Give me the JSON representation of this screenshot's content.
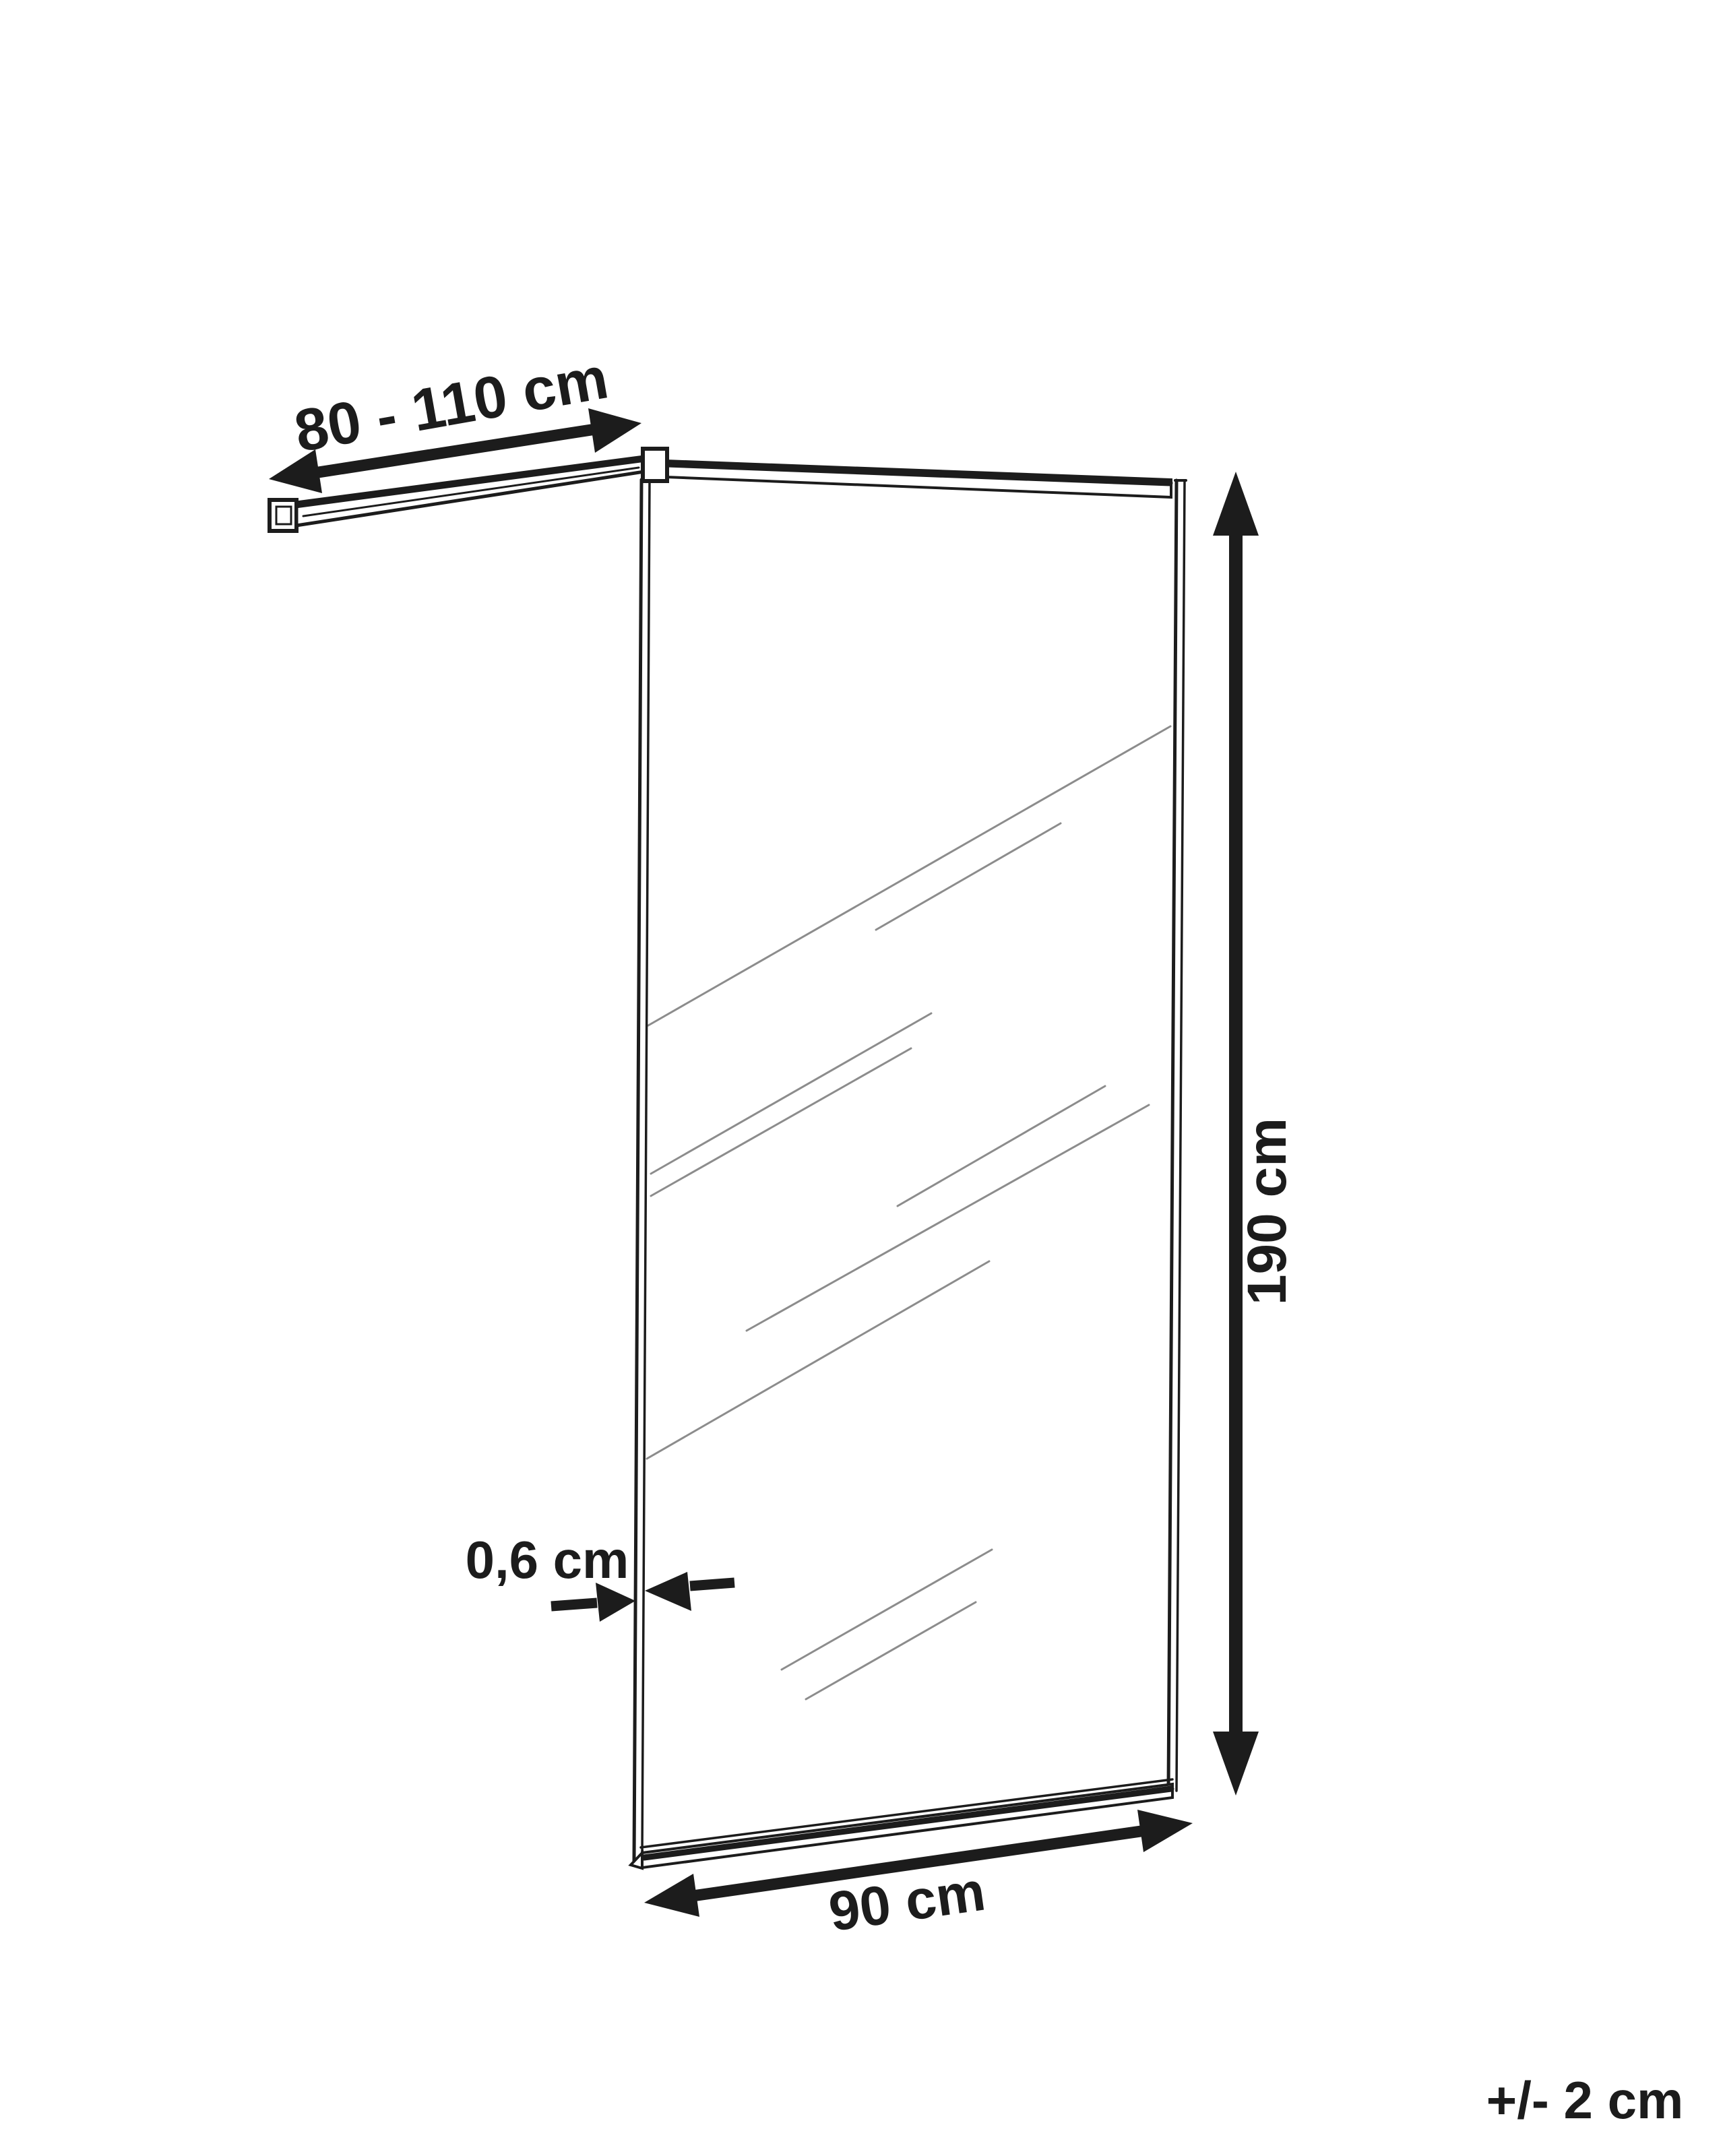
{
  "diagram": {
    "type": "product-dimension-drawing",
    "subject": "walk-in shower glass screen with ceiling support bar",
    "background_color": "#ffffff",
    "line_color": "#1c1c1c",
    "streak_color": "#8c8c8c",
    "dimensions": {
      "support_bar_length": {
        "label": "80 - 110 cm"
      },
      "height": {
        "label": "190 cm"
      },
      "glass_thickness": {
        "label": "0,6 cm"
      },
      "width": {
        "label": "90 cm"
      }
    },
    "tolerance": {
      "label": "+/- 2 cm"
    }
  }
}
